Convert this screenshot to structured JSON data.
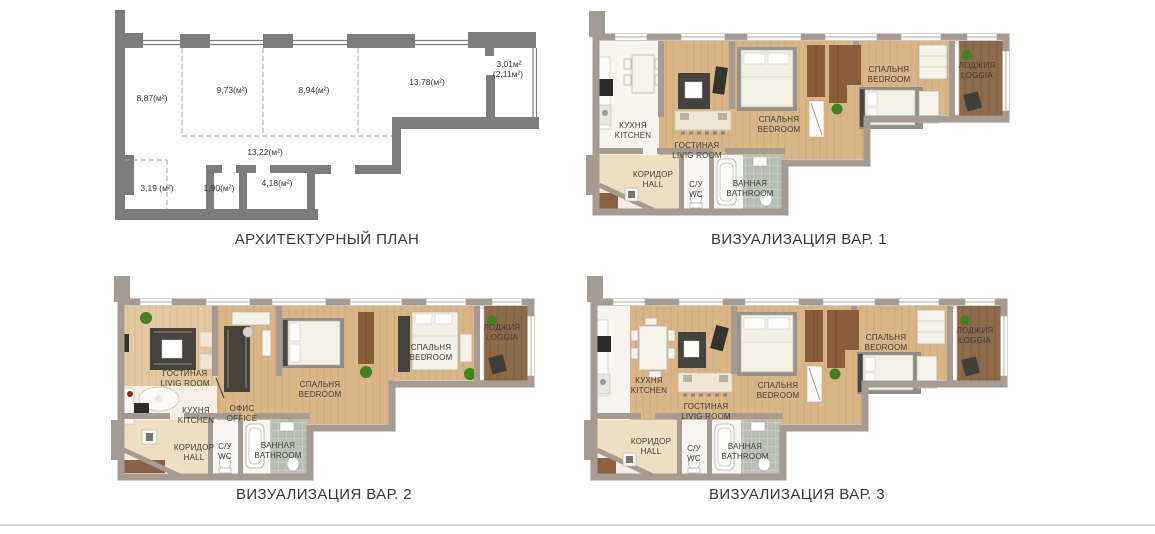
{
  "titles": {
    "architectural_plan": "АРХИТЕКТУРНЫЙ ПЛАН",
    "visualization_1": "ВИЗУАЛИЗАЦИЯ ВАР. 1",
    "visualization_2": "ВИЗУАЛИЗАЦИЯ ВАР. 2",
    "visualization_3": "ВИЗУАЛИЗАЦИЯ ВАР. 3"
  },
  "architectural_plan": {
    "areas": {
      "room_left": "8,87(м²)",
      "room_2": "9,73(м²)",
      "room_3": "8,94(м²)",
      "room_right": "13,78(м²)",
      "loggia_full": "3,01м²",
      "loggia_coef": "(2,11м²)",
      "corridor": "13,22(м²)",
      "niche": "3,19 (м²)",
      "wc": "1,90(м²)",
      "bathroom": "4,18(м²)"
    }
  },
  "room_labels": {
    "kitchen_ru": "КУХНЯ",
    "kitchen_en": "KITCHEN",
    "living_ru": "ГОСТИНАЯ",
    "living_en": "LIVIG ROOM",
    "bedroom_ru": "СПАЛЬНЯ",
    "bedroom_en": "BEDROOM",
    "office_ru": "ОФИС",
    "office_en": "OFFICE",
    "loggia_ru": "ЛОДЖИЯ",
    "loggia_en": "LOGGIA",
    "hall_ru": "КОРИДОР",
    "hall_en": "HALL",
    "wc_ru": "С/У",
    "wc_en": "WC",
    "bathroom_ru": "ВАННАЯ",
    "bathroom_en": "BATHROOM"
  },
  "colors": {
    "viz_wall": "#a59b92",
    "arch_wall": "#7c7c7c",
    "wood_floor": "#d8b687",
    "wood_floor_light": "#e2c9a0",
    "loggia_floor": "#8c6a4a",
    "hall_floor": "#ecdfc3",
    "white_floor": "#f6f4ee",
    "tile_floor": "#b9beb4",
    "rug_dark": "#45433e",
    "furniture_brown": "#8a5c38",
    "plant_green": "#43811f",
    "label_text": "#3f3e3b",
    "title_text": "#383838",
    "divider_line": "#d6d6d6"
  }
}
